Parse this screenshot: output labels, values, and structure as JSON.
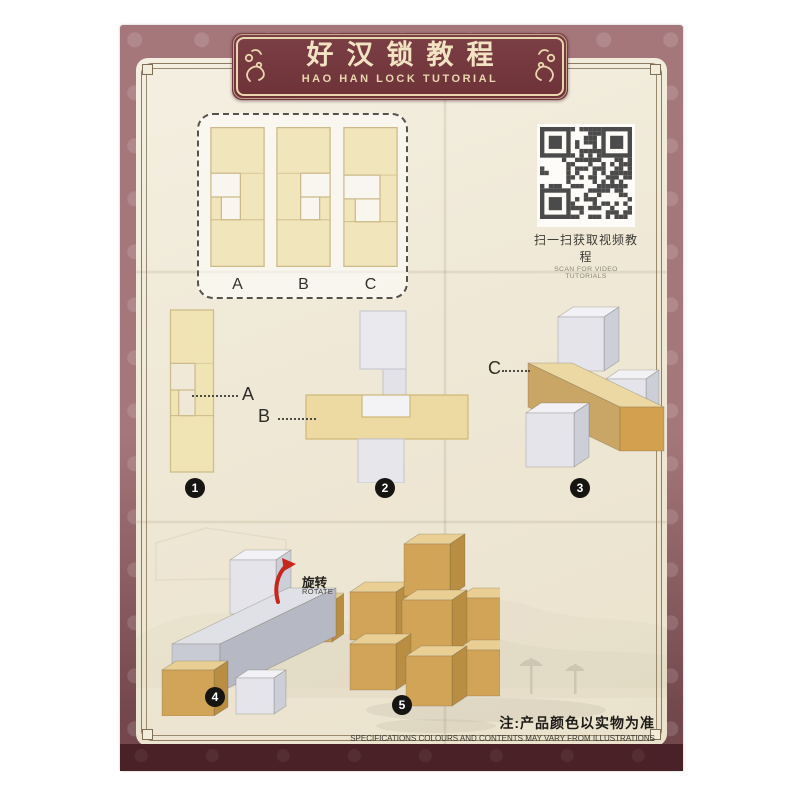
{
  "header": {
    "title_cn": "好汉锁教程",
    "title_en": "HAO HAN LOCK TUTORIAL"
  },
  "parts_box": {
    "labels": [
      "A",
      "B",
      "C"
    ]
  },
  "qr": {
    "caption_cn": "扫一扫获取视频教程",
    "caption_en": "SCAN FOR VIDEO TUTORIALS"
  },
  "steps": [
    {
      "number": "1",
      "callout": "A"
    },
    {
      "number": "2",
      "callout": "B"
    },
    {
      "number": "3",
      "callout": "C"
    },
    {
      "number": "4",
      "rotate_cn": "旋转",
      "rotate_en": "ROTATE"
    },
    {
      "number": "5"
    }
  ],
  "footer": {
    "note_cn": "注:产品颜色以实物为准",
    "note_en": "SPECIFICATIONS COLOURS AND CONTENTS MAY VARY FROM ILLUSTRATIONS"
  },
  "colors": {
    "border_mauve": "#a5767a",
    "banner_maroon": "#6d3138",
    "banner_text": "#f2e3c2",
    "bottom_band": "#4a2127",
    "paper": "#efe8d6",
    "wood_tan": "#f0e4b6",
    "wood_gold": "#d2a458",
    "wood_white": "#e4e4ea",
    "rotate_red": "#c6271d"
  }
}
